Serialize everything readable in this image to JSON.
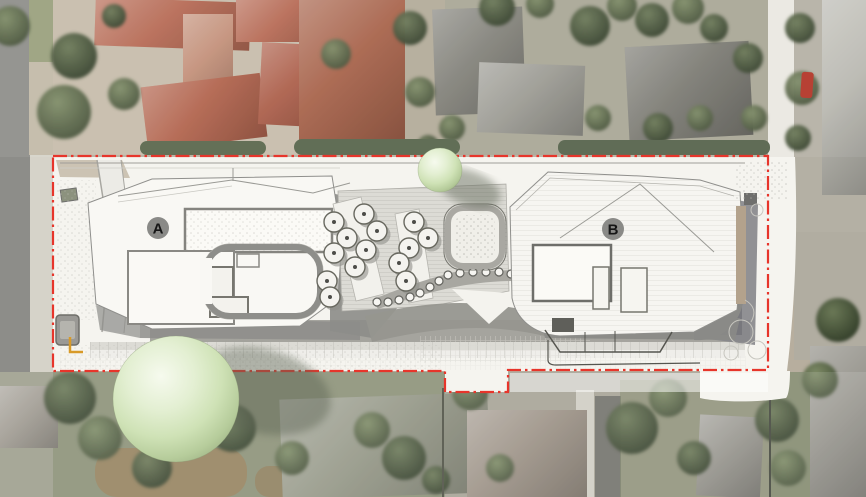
{
  "scene": {
    "width": 866,
    "height": 497,
    "description": "aerial-photo-with-architectural-site-plan-overlay"
  },
  "colors": {
    "boundary_red": "#e7352b",
    "paper": "#f5f4ef",
    "shadow_gray": "#8c8c89",
    "marker_gray": "#8a8a87",
    "marker_text": "#161616",
    "umbrella_fill": "#f4f3ef",
    "umbrella_stroke": "#68685f",
    "bollard_fill": "#f6f5f1",
    "bollard_stroke": "#63635e",
    "accent_yellow": "#d89a28",
    "pool_fill": "#f0efe9",
    "pool_border": "#a9a8a2",
    "sphere_hi": "#f6faee",
    "sphere_mid": "#d8e8c0",
    "sphere_edge": "#9db184",
    "roof_red": "#b2614a",
    "roof_gray": "#7c7b73",
    "foliage": "#55624a",
    "asphalt": "#8d8d89"
  },
  "site_plan": {
    "building_markers": [
      {
        "label": "A",
        "x": 158,
        "y": 228,
        "r": 11
      },
      {
        "label": "B",
        "x": 613,
        "y": 229,
        "r": 11
      }
    ],
    "boundary": {
      "path": "M53,156 L768,156 L768,370 L508,370 L508,392 L445,392 L445,371 L53,371 Z",
      "dash": "14 4 2.5 4",
      "width": 2.2
    },
    "round_trees": [
      {
        "x": 176,
        "y": 399,
        "r": 63,
        "shadow": {
          "x": 262,
          "y": 391,
          "rx": 70,
          "ry": 42,
          "rot": 14
        }
      },
      {
        "x": 440,
        "y": 170,
        "r": 22,
        "shadow": {
          "x": 469,
          "y": 188,
          "rx": 33,
          "ry": 17,
          "rot": 20
        }
      }
    ],
    "umbrellas": [
      {
        "x": 334,
        "y": 222
      },
      {
        "x": 347,
        "y": 238
      },
      {
        "x": 334,
        "y": 253
      },
      {
        "x": 364,
        "y": 214
      },
      {
        "x": 377,
        "y": 231
      },
      {
        "x": 366,
        "y": 250
      },
      {
        "x": 355,
        "y": 267
      },
      {
        "x": 414,
        "y": 222
      },
      {
        "x": 428,
        "y": 238
      },
      {
        "x": 409,
        "y": 248
      },
      {
        "x": 399,
        "y": 263
      },
      {
        "x": 406,
        "y": 281
      },
      {
        "x": 327,
        "y": 281
      },
      {
        "x": 330,
        "y": 297
      }
    ],
    "umbrella_r": 10,
    "bollards": [
      {
        "x": 377,
        "y": 302
      },
      {
        "x": 388,
        "y": 302
      },
      {
        "x": 399,
        "y": 300
      },
      {
        "x": 410,
        "y": 297
      },
      {
        "x": 420,
        "y": 293
      },
      {
        "x": 430,
        "y": 287
      },
      {
        "x": 439,
        "y": 281
      },
      {
        "x": 448,
        "y": 275
      },
      {
        "x": 460,
        "y": 273
      },
      {
        "x": 473,
        "y": 272
      },
      {
        "x": 486,
        "y": 272
      },
      {
        "x": 499,
        "y": 272
      },
      {
        "x": 511,
        "y": 274
      }
    ],
    "bollard_r": 4,
    "pool": {
      "x": 448,
      "y": 208,
      "w": 54,
      "h": 58,
      "rx": 15
    }
  },
  "aerial": {
    "under": [
      {
        "n": "road-asphalt",
        "x": 0,
        "y": 0,
        "w": 30,
        "h": 497,
        "c": "#8d8d89"
      },
      {
        "n": "sidewalk",
        "x": 30,
        "y": 0,
        "w": 23,
        "h": 497,
        "c": "#d6d3c9"
      },
      {
        "n": "lawn-verge",
        "x": 29,
        "y": 0,
        "w": 24,
        "h": 62,
        "c": "#99a07c"
      },
      {
        "n": "verge-tan",
        "x": 29,
        "y": 62,
        "w": 24,
        "h": 93,
        "c": "#c2baa7"
      },
      {
        "n": "ground-topleft",
        "x": 53,
        "y": 0,
        "w": 262,
        "h": 155,
        "c": "#c6bcaa"
      },
      {
        "n": "ground-topmid",
        "x": 315,
        "y": 0,
        "w": 130,
        "h": 155,
        "c": "#b2aa98"
      },
      {
        "n": "ground-topright",
        "x": 445,
        "y": 0,
        "w": 324,
        "h": 155,
        "c": "#a8a695"
      },
      {
        "n": "road-white-vertical",
        "x": 768,
        "y": 0,
        "w": 26,
        "h": 157,
        "c": "#eae8e1"
      },
      {
        "n": "ground-right",
        "x": 794,
        "y": 0,
        "w": 72,
        "h": 232,
        "c": "#b4b0a4"
      },
      {
        "n": "driveway-right",
        "x": 794,
        "y": 232,
        "w": 72,
        "h": 128,
        "c": "#b1ada1"
      },
      {
        "n": "ground-bottom",
        "x": 0,
        "y": 372,
        "w": 866,
        "h": 125,
        "c": "#9b9d8a"
      },
      {
        "n": "green-bottomleft",
        "x": 53,
        "y": 372,
        "w": 392,
        "h": 125,
        "c": "#78815f",
        "o": 0.5
      },
      {
        "n": "dirt-patch",
        "x": 95,
        "y": 448,
        "w": 152,
        "h": 49,
        "c": "#93805c",
        "rx": 22
      },
      {
        "n": "dirt-patch",
        "x": 255,
        "y": 466,
        "w": 72,
        "h": 31,
        "c": "#8e7b58",
        "rx": 14,
        "o": 0.85
      },
      {
        "n": "ground-bottommid",
        "x": 445,
        "y": 372,
        "w": 324,
        "h": 125,
        "c": "#a5a294",
        "o": 0.9
      },
      {
        "n": "driveway-bottom-dark",
        "x": 595,
        "y": 396,
        "w": 26,
        "h": 101,
        "c": "#6f6f68"
      },
      {
        "n": "driveway-bottom-light",
        "x": 576,
        "y": 390,
        "w": 18,
        "h": 107,
        "c": "#cfccc2"
      },
      {
        "n": "green-bottomright",
        "x": 620,
        "y": 380,
        "w": 150,
        "h": 117,
        "c": "#7d8565",
        "o": 0.55
      },
      {
        "n": "trees-right-base",
        "x": 770,
        "y": 372,
        "w": 50,
        "h": 125,
        "c": "#6f7a58",
        "o": 0.6
      }
    ],
    "houses": [
      {
        "n": "red-roof-house",
        "x": 95,
        "y": 0,
        "w": 155,
        "h": 48,
        "c": "#b2614a",
        "rot": 2
      },
      {
        "n": "red-roof-house",
        "x": 183,
        "y": 14,
        "w": 50,
        "h": 94,
        "c": "#c08a72",
        "rot": 0
      },
      {
        "n": "red-roof-house",
        "x": 144,
        "y": 80,
        "w": 120,
        "h": 64,
        "c": "#ad5a42",
        "rot": -7
      },
      {
        "n": "red-roof-house",
        "x": 236,
        "y": 0,
        "w": 100,
        "h": 42,
        "c": "#b2614a",
        "rot": 0
      },
      {
        "n": "red-roof-house",
        "x": 260,
        "y": 44,
        "w": 74,
        "h": 82,
        "c": "#a85640",
        "rot": 3
      },
      {
        "n": "red-roof-house",
        "x": 299,
        "y": 0,
        "w": 106,
        "h": 143,
        "c": "#a2593f",
        "rot": 0
      },
      {
        "n": "gray-roof-house",
        "x": 434,
        "y": 8,
        "w": 90,
        "h": 106,
        "c": "#7c7b73",
        "rot": -2
      },
      {
        "n": "gray-roof-house",
        "x": 478,
        "y": 64,
        "w": 106,
        "h": 70,
        "c": "#96958d",
        "rot": 2
      },
      {
        "n": "gray-roof-house",
        "x": 627,
        "y": 44,
        "w": 124,
        "h": 94,
        "c": "#74736b",
        "rot": -3
      },
      {
        "n": "light-building",
        "x": 822,
        "y": 0,
        "w": 44,
        "h": 195,
        "c": "#b6b5ad",
        "rot": 0
      },
      {
        "n": "house-bottomleft",
        "x": 0,
        "y": 386,
        "w": 58,
        "h": 62,
        "c": "#99948a",
        "rot": 0
      },
      {
        "n": "house-bottomcenter",
        "x": 281,
        "y": 396,
        "w": 208,
        "h": 100,
        "c": "#8b8e7c",
        "rot": -2
      },
      {
        "n": "house-bottom",
        "x": 467,
        "y": 410,
        "w": 120,
        "h": 87,
        "c": "#94897c",
        "rot": 0
      },
      {
        "n": "house-bottomright",
        "x": 698,
        "y": 416,
        "w": 64,
        "h": 81,
        "c": "#8d8b83",
        "rot": 3
      },
      {
        "n": "house-farright",
        "x": 810,
        "y": 346,
        "w": 56,
        "h": 151,
        "c": "#939189",
        "rot": 0
      }
    ],
    "trees": [
      {
        "x": 10,
        "y": 26,
        "r": 20
      },
      {
        "x": 74,
        "y": 56,
        "r": 23,
        "v": 1
      },
      {
        "x": 64,
        "y": 112,
        "r": 27
      },
      {
        "x": 124,
        "y": 94,
        "r": 16
      },
      {
        "x": 114,
        "y": 16,
        "r": 12,
        "v": 1
      },
      {
        "x": 336,
        "y": 54,
        "r": 15
      },
      {
        "x": 410,
        "y": 28,
        "r": 17,
        "v": 1
      },
      {
        "x": 420,
        "y": 92,
        "r": 15
      },
      {
        "x": 452,
        "y": 128,
        "r": 13
      },
      {
        "x": 428,
        "y": 146,
        "r": 11,
        "v": 1
      },
      {
        "x": 497,
        "y": 8,
        "r": 18,
        "v": 1
      },
      {
        "x": 540,
        "y": 4,
        "r": 14
      },
      {
        "x": 590,
        "y": 26,
        "r": 20,
        "v": 1
      },
      {
        "x": 622,
        "y": 6,
        "r": 15
      },
      {
        "x": 652,
        "y": 20,
        "r": 17,
        "v": 1
      },
      {
        "x": 688,
        "y": 8,
        "r": 16
      },
      {
        "x": 714,
        "y": 28,
        "r": 14,
        "v": 1
      },
      {
        "x": 598,
        "y": 118,
        "r": 13
      },
      {
        "x": 658,
        "y": 128,
        "r": 15,
        "v": 1
      },
      {
        "x": 700,
        "y": 118,
        "r": 13
      },
      {
        "x": 748,
        "y": 58,
        "r": 15,
        "v": 1
      },
      {
        "x": 754,
        "y": 118,
        "r": 13
      },
      {
        "x": 800,
        "y": 28,
        "r": 15,
        "v": 1
      },
      {
        "x": 802,
        "y": 88,
        "r": 17
      },
      {
        "x": 798,
        "y": 138,
        "r": 13,
        "v": 1
      },
      {
        "x": 70,
        "y": 398,
        "r": 26,
        "v": 1
      },
      {
        "x": 100,
        "y": 438,
        "r": 22
      },
      {
        "x": 152,
        "y": 468,
        "r": 20,
        "v": 1
      },
      {
        "x": 232,
        "y": 428,
        "r": 24,
        "v": 1
      },
      {
        "x": 292,
        "y": 458,
        "r": 17
      },
      {
        "x": 404,
        "y": 458,
        "r": 22,
        "v": 1
      },
      {
        "x": 372,
        "y": 430,
        "r": 18
      },
      {
        "x": 436,
        "y": 480,
        "r": 14,
        "v": 1
      },
      {
        "x": 470,
        "y": 392,
        "r": 18
      },
      {
        "x": 500,
        "y": 468,
        "r": 14
      },
      {
        "x": 632,
        "y": 428,
        "r": 26,
        "v": 1
      },
      {
        "x": 668,
        "y": 398,
        "r": 19
      },
      {
        "x": 694,
        "y": 458,
        "r": 17,
        "v": 1
      },
      {
        "x": 777,
        "y": 420,
        "r": 22,
        "v": 1
      },
      {
        "x": 788,
        "y": 468,
        "r": 18
      },
      {
        "x": 838,
        "y": 320,
        "r": 22,
        "v": 1
      },
      {
        "x": 820,
        "y": 380,
        "r": 18
      }
    ],
    "over": [
      {
        "n": "hedge-row",
        "x": 140,
        "y": 141,
        "w": 126,
        "h": 14,
        "c": "#59664b",
        "rx": 7
      },
      {
        "n": "hedge-row",
        "x": 294,
        "y": 139,
        "w": 166,
        "h": 16,
        "c": "#56634a",
        "rx": 8
      },
      {
        "n": "hedge-row",
        "x": 558,
        "y": 140,
        "w": 212,
        "h": 15,
        "c": "#54614a",
        "rx": 7
      },
      {
        "n": "fence-line",
        "x": 442,
        "y": 388,
        "w": 2,
        "h": 109,
        "c": "#4a4d40"
      },
      {
        "n": "fence-line",
        "x": 769,
        "y": 372,
        "w": 2,
        "h": 125,
        "c": "#3f4238"
      },
      {
        "n": "red-car",
        "x": 801,
        "y": 72,
        "w": 12,
        "h": 26,
        "c": "#b23325",
        "rx": 3,
        "rot": 4
      },
      {
        "n": "photo-wash-top",
        "x": 0,
        "y": 0,
        "w": 866,
        "h": 157,
        "c": "#ffffff",
        "o": 0.07
      },
      {
        "n": "photo-wash-bottom",
        "x": 0,
        "y": 372,
        "w": 866,
        "h": 125,
        "c": "#ffffff",
        "o": 0.12
      }
    ]
  }
}
